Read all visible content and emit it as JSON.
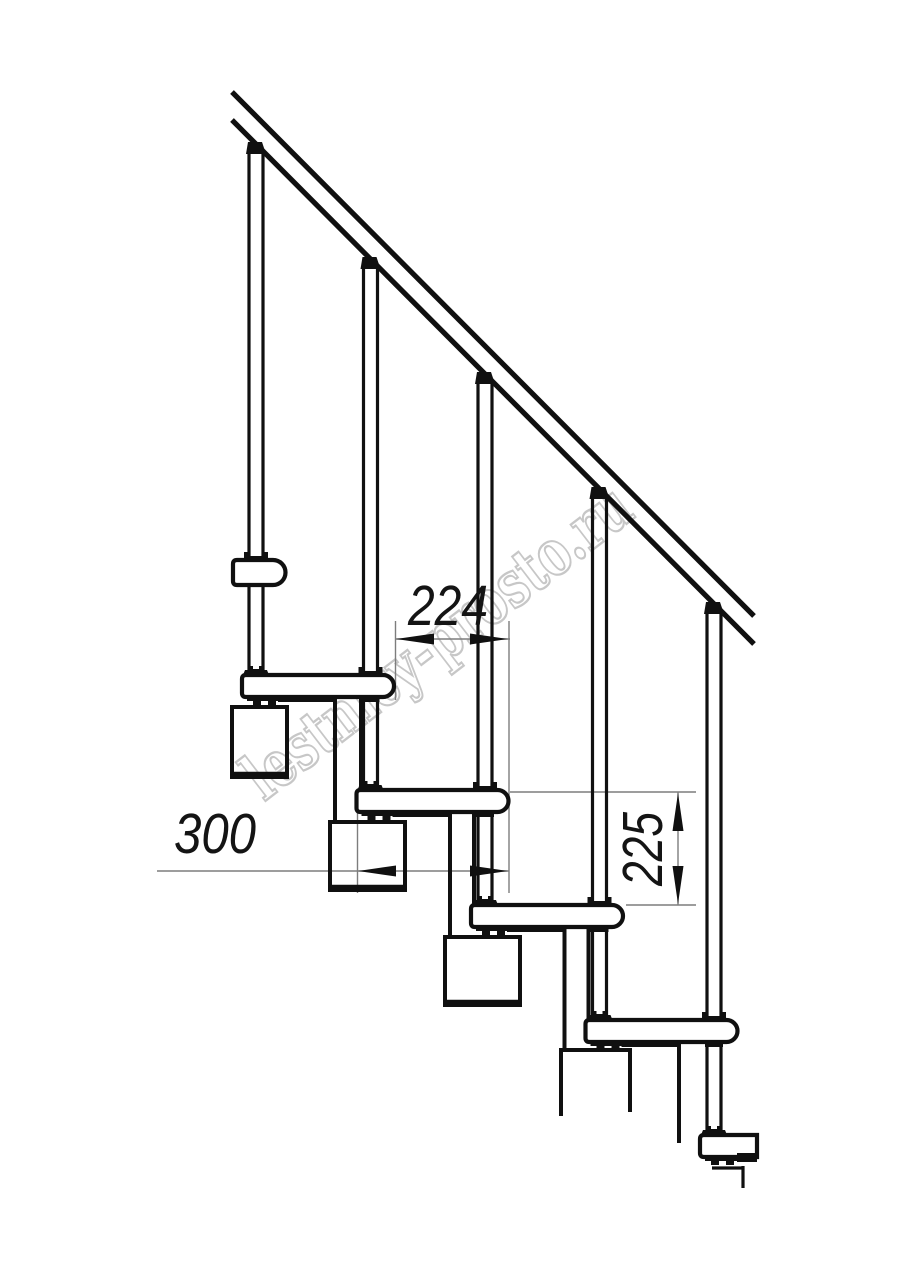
{
  "title": "Modular staircase side-view technical drawing",
  "watermark": {
    "text": "lestnicy-prosto.ru",
    "color": "#c7c7c7"
  },
  "dimensions": [
    {
      "id": "step-run",
      "value": "224",
      "orientation": "horizontal",
      "measures": "horizontal distance between tread noses"
    },
    {
      "id": "tread-depth",
      "value": "300",
      "orientation": "horizontal",
      "measures": "tread depth"
    },
    {
      "id": "step-rise",
      "value": "225",
      "orientation": "vertical",
      "measures": "rise between treads"
    }
  ],
  "colors": {
    "line": "#101010",
    "dimension_line": "#7d7d7d",
    "watermark": "#c7c7c7",
    "background": "#ffffff"
  }
}
